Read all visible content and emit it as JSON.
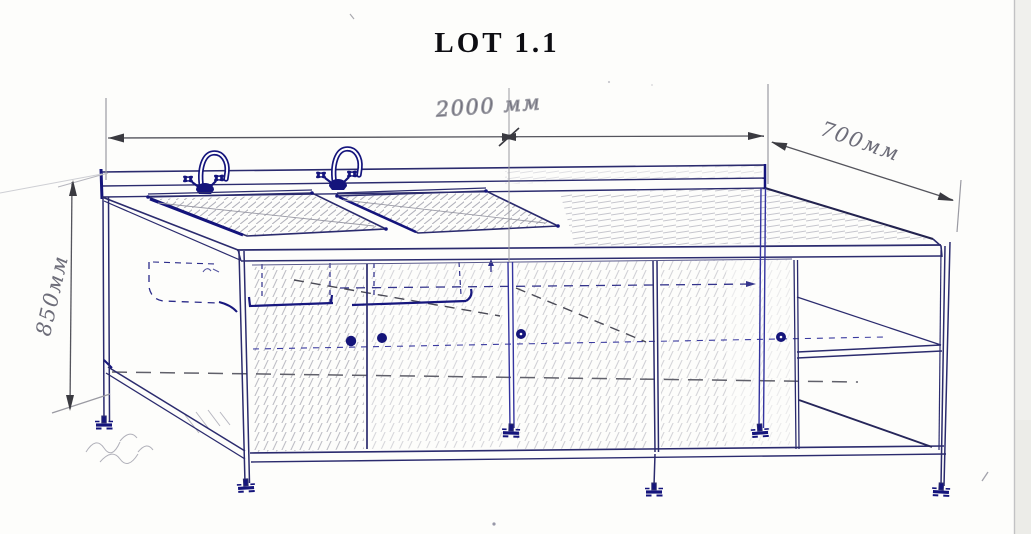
{
  "title": "LOT 1.1",
  "dimensions": {
    "width": {
      "label": "2000 мм",
      "value_mm": 2000,
      "orientation": "horizontal",
      "location": "top edge"
    },
    "depth": {
      "label": "700мм",
      "value_mm": 700,
      "orientation": "diagonal",
      "location": "top right edge"
    },
    "height": {
      "label": "850мм",
      "value_mm": 850,
      "orientation": "vertical",
      "location": "left edge"
    }
  },
  "figure": {
    "kind": "hand-drawn perspective sketch",
    "subject": "double-bowl sink work table with under-counter cabinet and open side shelves",
    "faucets": 2,
    "sink_bowls": 2,
    "door_knobs": 4,
    "adjustable_feet": 6
  },
  "colors": {
    "paper": "#fdfdfb",
    "ink": "#2b2b6e",
    "accent_ink": "#14147c",
    "pencil": "#8d8d96",
    "title_text": "#0d0d12"
  }
}
